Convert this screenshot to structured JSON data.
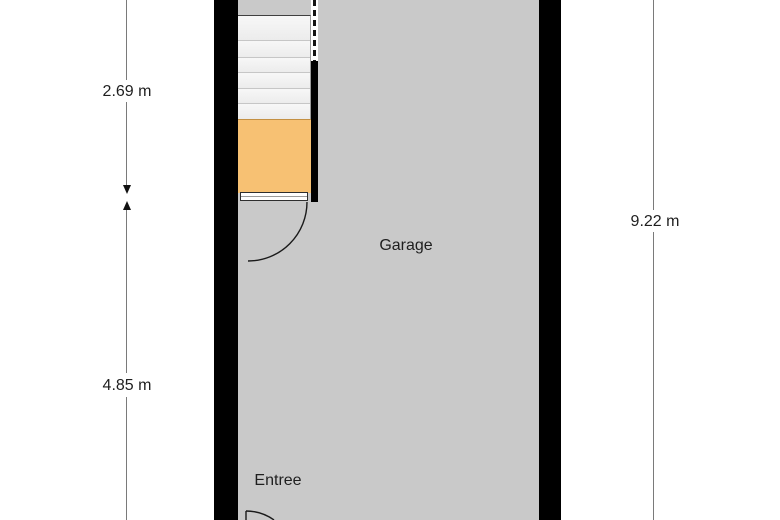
{
  "floor_plan": {
    "rooms": [
      {
        "name": "Garage"
      },
      {
        "name": "Entree"
      }
    ],
    "dimensions": [
      {
        "label": "2.69 m",
        "side": "left",
        "section": "upper"
      },
      {
        "label": "4.85 m",
        "side": "left",
        "section": "lower"
      },
      {
        "label": "9.22 m",
        "side": "right",
        "section": "full"
      }
    ],
    "features": [
      {
        "name": "staircase",
        "steps": 6
      },
      {
        "name": "storage-area"
      },
      {
        "name": "garage-door-swing"
      },
      {
        "name": "entree-door-swing"
      },
      {
        "name": "stair-clearance-dashed-line"
      }
    ],
    "colors": {
      "wall": "#000000",
      "floor": "#c9c9c9",
      "stairs": "#f0f0f0",
      "storage": "#f7c173",
      "background": "#ffffff",
      "dimension_line": "#7a7a7a",
      "text": "#1f1f1f"
    }
  }
}
